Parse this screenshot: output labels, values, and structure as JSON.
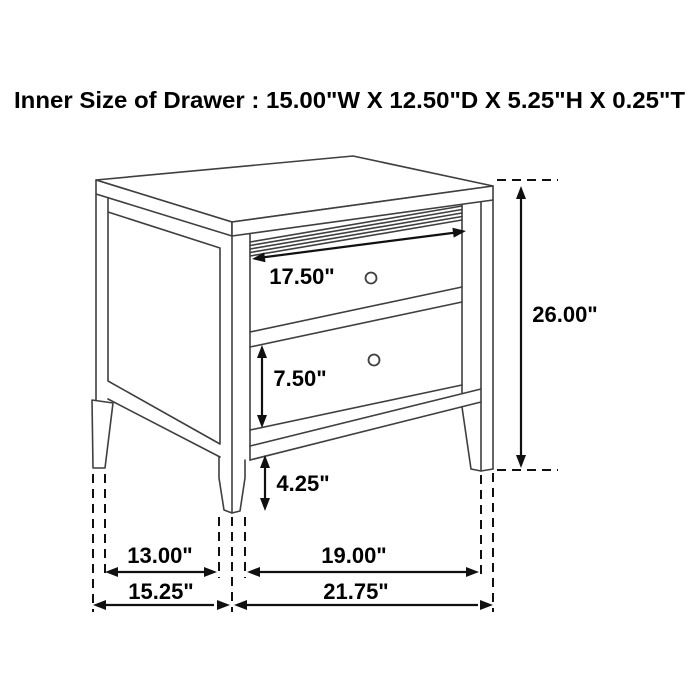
{
  "title": "Inner Size of Drawer : 15.00\"W X 12.50\"D X 5.25\"H X 0.25\"T",
  "dims": {
    "drawer_front_width": "17.50\"",
    "overall_height": "26.00\"",
    "drawer_face_height": "7.50\"",
    "floor_clearance": "4.25\"",
    "side_inner_depth": "13.00\"",
    "overall_depth": "15.25\"",
    "front_inner_width": "19.00\"",
    "overall_width": "21.75\""
  },
  "style": {
    "background": "#ffffff",
    "furniture_line_color": "#3f3f3f",
    "dimension_line_color": "#101010",
    "text_color": "#000000"
  }
}
